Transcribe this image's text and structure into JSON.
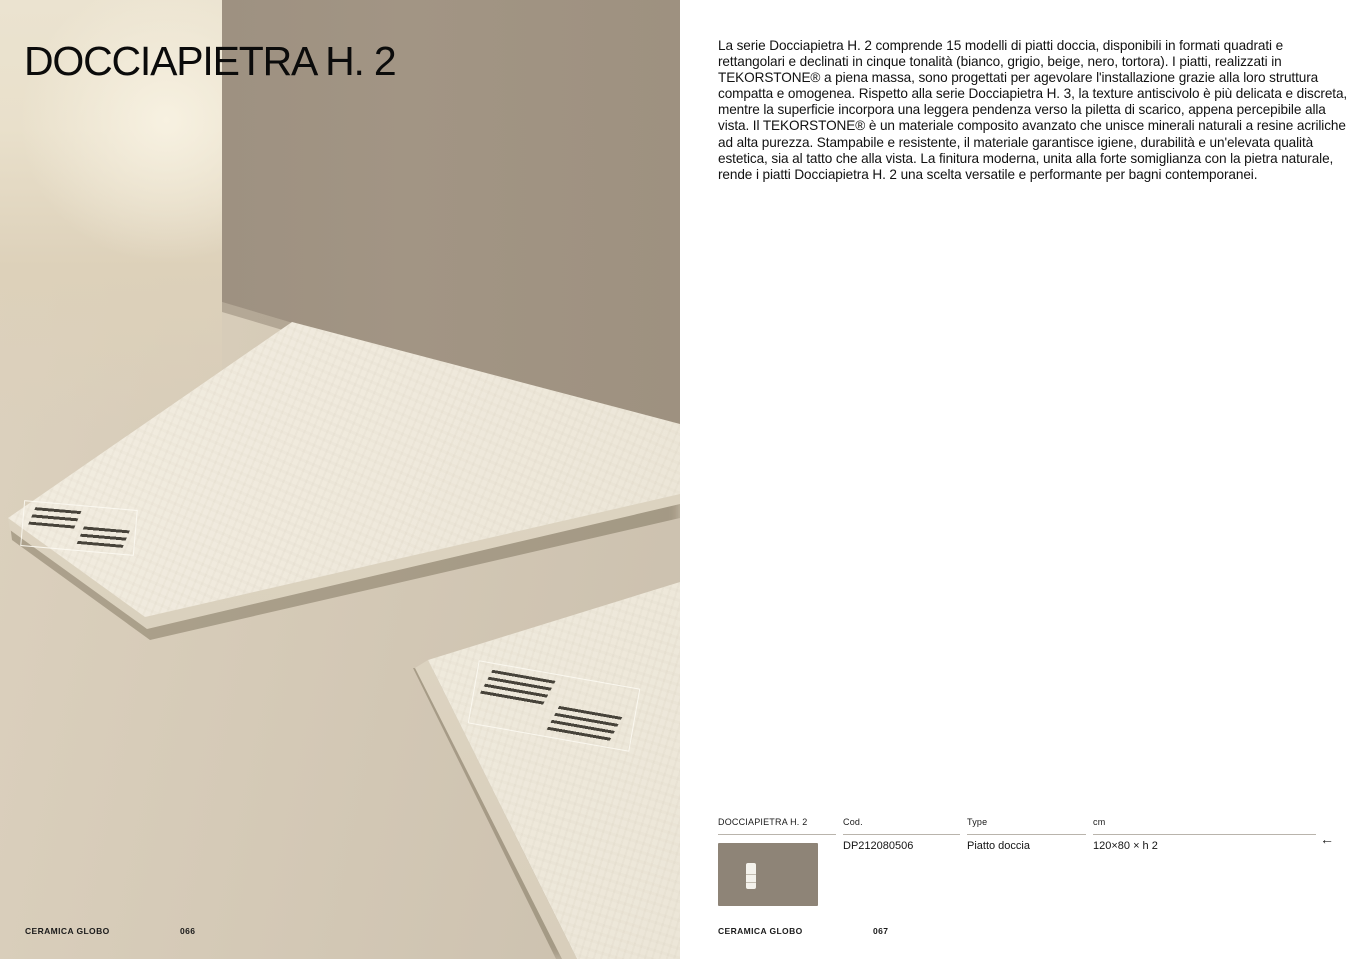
{
  "page_title": "DOCCIAPIETRA H. 2",
  "description": "La serie Docciapietra H. 2 comprende 15 modelli di piatti doccia, disponibili in formati quadrati e rettangolari e declinati in cinque tonalità (bianco, grigio, beige, nero, tortora). I piatti, realizzati in TEKORSTONE® a piena massa, sono progettati per agevolare l'installazione grazie alla loro struttura compatta e omogenea. Rispetto alla serie Docciapietra H. 3, la texture antiscivolo è più delicata e discreta, mentre la superficie incorpora una leggera pendenza verso la piletta di scarico, appena percepibile alla vista. Il TEKORSTONE® è un materiale composito avanzato che unisce minerali naturali a resine acriliche ad alta purezza. Stampabile e resistente, il materiale garantisce igiene, durabilità e un'elevata qualità estetica, sia al tatto che alla vista. La finitura moderna, unita alla forte somiglianza con la pietra naturale, rende i piatti Docciapietra H. 2 una scelta versatile e performante per bagni contemporanei.",
  "product_table": {
    "col_series": "DOCCIAPIETRA H. 2",
    "col_cod": "Cod.",
    "col_type": "Type",
    "col_cm": "cm",
    "row": {
      "cod": "DP212080506",
      "type": "Piatto doccia",
      "cm": "120×80 × h 2"
    },
    "back_arrow": "←",
    "swatch_color": "#8e8477"
  },
  "footer_left": {
    "brand": "CERAMICA GLOBO",
    "page_number": "066"
  },
  "footer_right": {
    "brand": "CERAMICA GLOBO",
    "page_number": "067"
  },
  "photo": {
    "colors": {
      "taupe_wall": "#9c8f7d",
      "back_wall_cream": "#ece4d2",
      "floor_beige": "#d5cab7",
      "shower_tray": "#f0ebde"
    }
  }
}
